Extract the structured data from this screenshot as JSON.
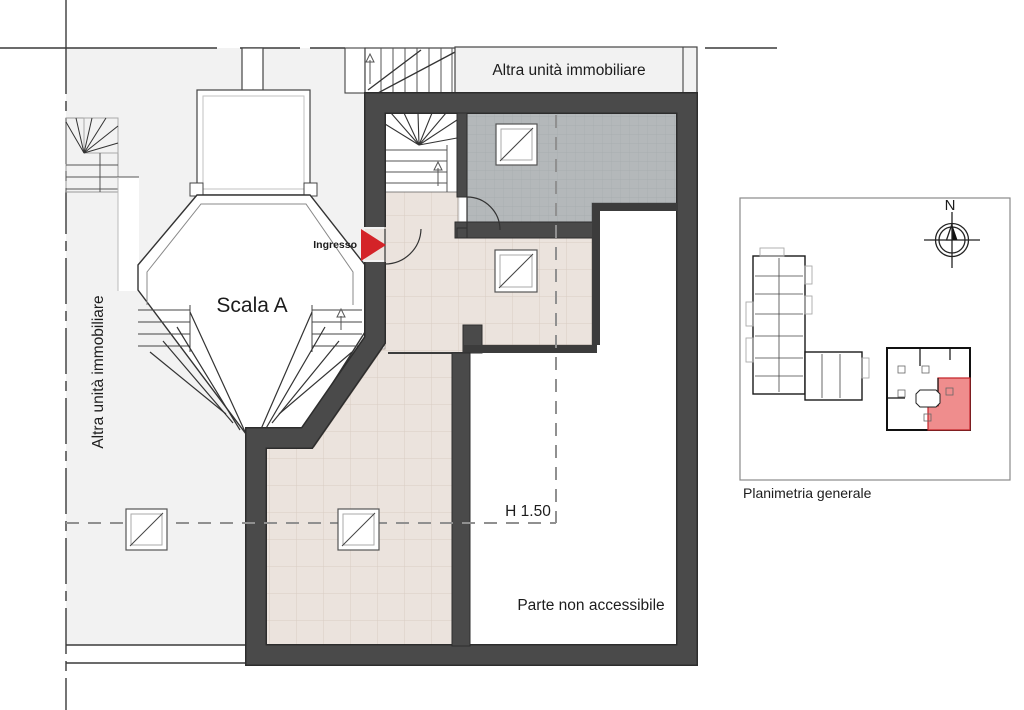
{
  "plan": {
    "top_band_label": "Altra unità immobiliare",
    "left_label": "Altra unità immobiliare",
    "stairwell_label": "Scala A",
    "entrance_label": "Ingresso",
    "height_note": "H 1.50",
    "inaccessible_label": "Parte non accessibile"
  },
  "key_plan": {
    "caption": "Planimetria generale",
    "north_label": "N"
  },
  "colors": {
    "wall": "#4a4a4a",
    "wall_edge": "#2d2d2d",
    "accent_red": "#d42328",
    "highlight_fill": "#ef8d8d",
    "highlight_stroke": "#c4262b",
    "terrace_gray": "#b4b8ba",
    "tile_beige": "#ebe3dd",
    "roof_gray": "#f2f2f2",
    "dashed_line": "#909090"
  }
}
